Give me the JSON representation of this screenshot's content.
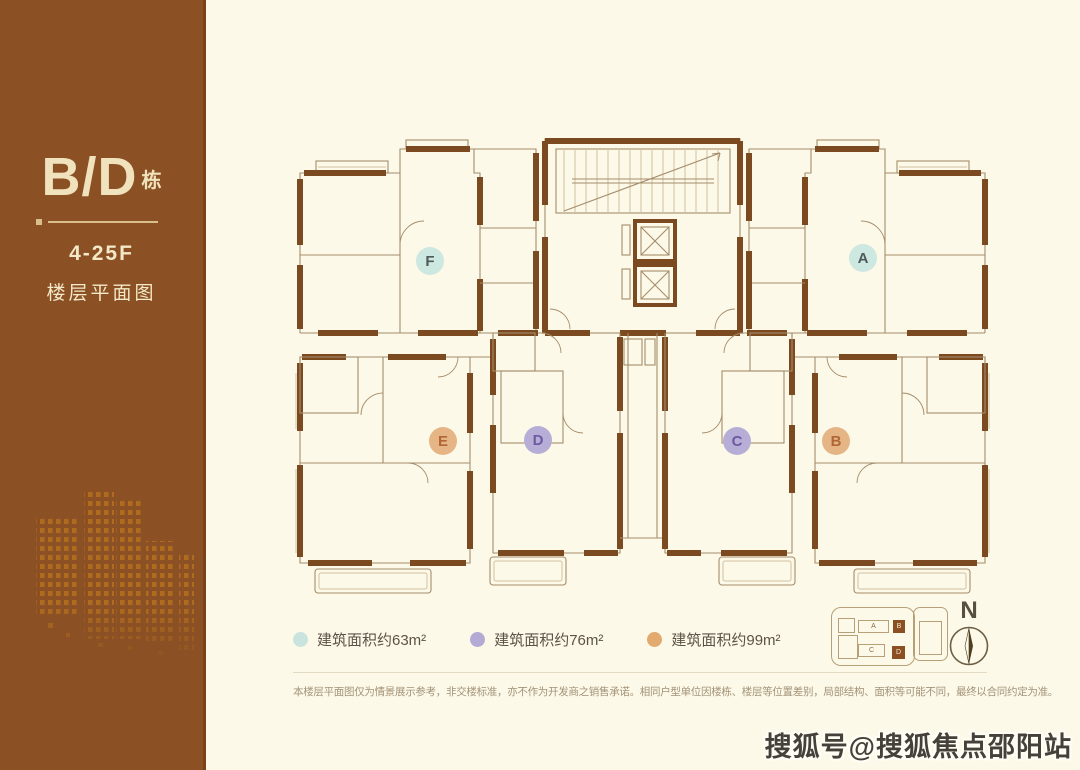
{
  "sidebar": {
    "building_label": "B/D",
    "building_suffix": "栋",
    "floors": "4-25F",
    "subtitle": "楼层平面图",
    "brand_brown": "#8b5124",
    "cream_text": "#f2e6c2"
  },
  "plan": {
    "wall_color": "#7b4a21",
    "units": [
      {
        "id": "F",
        "x": 430,
        "y": 261,
        "color": "#cde7e1",
        "text_color": "#4f5a58"
      },
      {
        "id": "A",
        "x": 863,
        "y": 258,
        "color": "#cde7e1",
        "text_color": "#4f5a58"
      },
      {
        "id": "E",
        "x": 443,
        "y": 441,
        "color": "#e5b586",
        "text_color": "#b26636"
      },
      {
        "id": "D",
        "x": 538,
        "y": 440,
        "color": "#b7aed8",
        "text_color": "#6a5aa0"
      },
      {
        "id": "C",
        "x": 737,
        "y": 441,
        "color": "#b7aed8",
        "text_color": "#6a5aa0"
      },
      {
        "id": "B",
        "x": 836,
        "y": 441,
        "color": "#e5b586",
        "text_color": "#b26636"
      }
    ]
  },
  "legend": {
    "items": [
      {
        "label": "建筑面积约63m²",
        "color": "#c9e4df"
      },
      {
        "label": "建筑面积约76m²",
        "color": "#b4abd5"
      },
      {
        "label": "建筑面积约99m²",
        "color": "#e2aa6e"
      }
    ]
  },
  "disclaimer": "本楼层平面图仅为情景展示参考，非交楼标准，亦不作为开发商之销售承诺。相同户型单位因楼栋、楼层等位置差别，局部结构、面积等可能不同，最终以合同约定为准。",
  "keyplan": {
    "units": [
      {
        "id": "A",
        "x": 26,
        "y": 12,
        "w": 31,
        "h": 13,
        "highlight": false
      },
      {
        "id": "B",
        "x": 61,
        "y": 12,
        "w": 12,
        "h": 13,
        "highlight": true
      },
      {
        "id": "C",
        "x": 26,
        "y": 36,
        "w": 27,
        "h": 13,
        "highlight": false
      },
      {
        "id": "D",
        "x": 60,
        "y": 38,
        "w": 13,
        "h": 13,
        "highlight": true
      }
    ]
  },
  "compass": {
    "label": "N"
  },
  "watermark": "搜狐号@搜狐焦点邵阳站"
}
